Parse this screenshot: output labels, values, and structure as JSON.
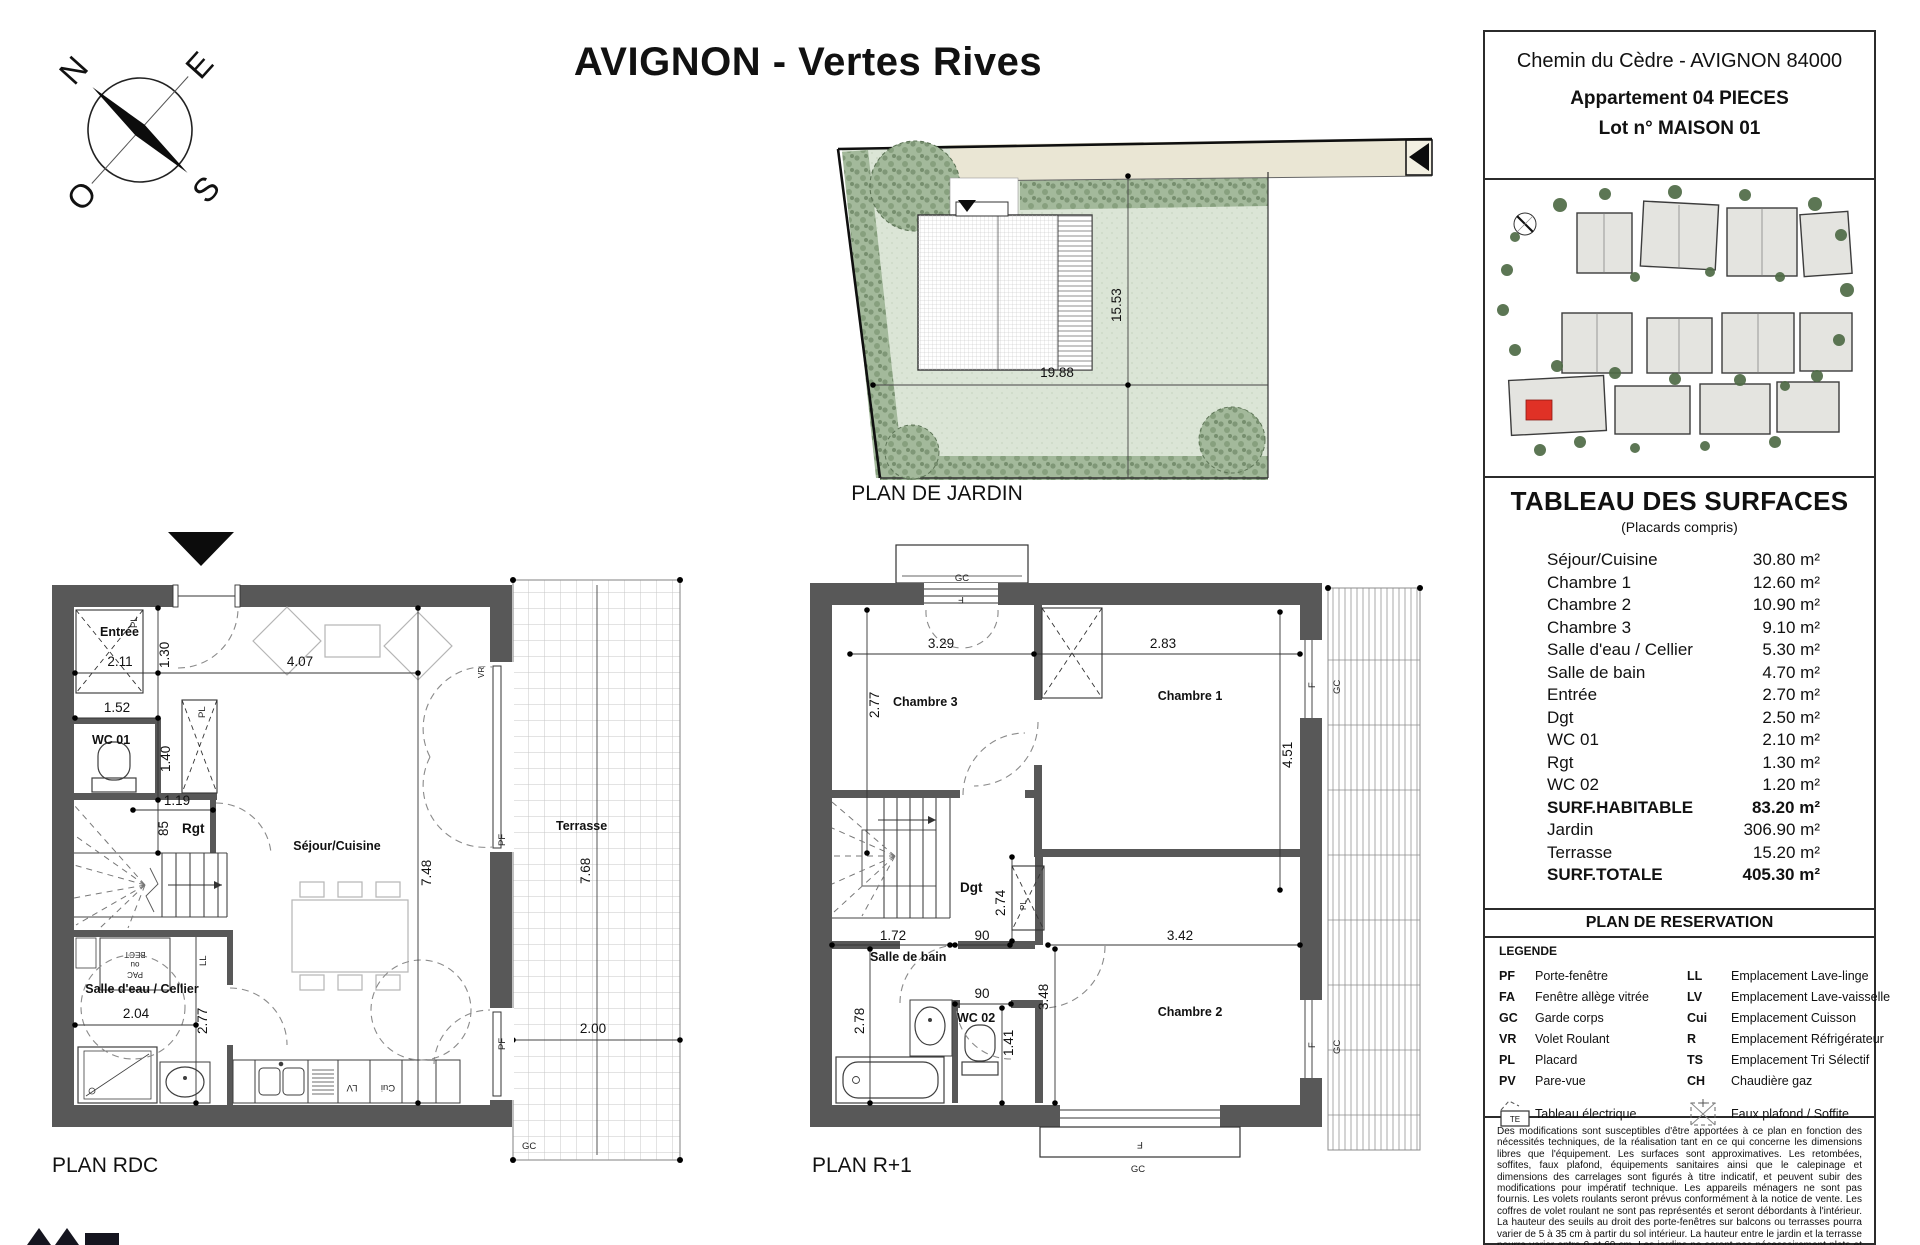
{
  "title": "AVIGNON - Vertes Rives",
  "compass": {
    "n": "N",
    "e": "E",
    "s": "S",
    "o": "O"
  },
  "garden": {
    "label": "PLAN DE JARDIN",
    "d_width": "19.88",
    "d_height": "15.53"
  },
  "rdc": {
    "label": "PLAN RDC",
    "entree": "Entrée",
    "wc01": "WC 01",
    "rgt": "Rgt",
    "sejour": "Séjour/Cuisine",
    "salle_eau": "Salle d'eau / Cellier",
    "terrasse": "Terrasse",
    "d211": "2.11",
    "d130": "1.30",
    "d407": "4.07",
    "d152": "1.52",
    "d140": "1.40",
    "d119": "1.19",
    "d85": "85",
    "d748": "7.48",
    "d204": "2.04",
    "d277": "2.77",
    "d768": "7.68",
    "d200": "2.00",
    "pf": "PF",
    "vr": "VR",
    "gc": "GC",
    "pl": "PL",
    "ll": "LL",
    "lv": "LV",
    "cui": "Cui",
    "pac1": "BECT",
    "pac2": "ou",
    "pac3": "PAC"
  },
  "r1": {
    "label": "PLAN R+1",
    "ch1": "Chambre 1",
    "ch2": "Chambre 2",
    "ch3": "Chambre 3",
    "dgt": "Dgt",
    "sdb": "Salle de bain",
    "wc02": "WC 02",
    "d329": "3.29",
    "d283": "2.83",
    "d277": "2.77",
    "d451": "4.51",
    "d274": "2.74",
    "d172": "1.72",
    "d90a": "90",
    "d90b": "90",
    "d141": "1.41",
    "d342": "3.42",
    "d348": "3.48",
    "d278": "2.78",
    "gc": "GC",
    "f": "F",
    "pl": "PL"
  },
  "sidebar": {
    "address": "Chemin du Cèdre - AVIGNON 84000",
    "apartment": "Appartement 04 PIECES",
    "lot": "Lot n° MAISON 01",
    "surfaces": {
      "title": "TABLEAU DES SURFACES",
      "subtitle": "(Placards compris)",
      "rows": [
        {
          "label": "Séjour/Cuisine",
          "value": "30.80 m²"
        },
        {
          "label": "Chambre 1",
          "value": "12.60 m²"
        },
        {
          "label": "Chambre 2",
          "value": "10.90 m²"
        },
        {
          "label": "Chambre 3",
          "value": "9.10 m²"
        },
        {
          "label": "Salle d'eau / Cellier",
          "value": "5.30 m²"
        },
        {
          "label": "Salle de bain",
          "value": "4.70 m²"
        },
        {
          "label": "Entrée",
          "value": "2.70 m²"
        },
        {
          "label": "Dgt",
          "value": "2.50 m²"
        },
        {
          "label": "WC 01",
          "value": "2.10 m²"
        },
        {
          "label": "Rgt",
          "value": "1.30 m²"
        },
        {
          "label": "WC 02",
          "value": "1.20 m²"
        },
        {
          "label": "SURF.HABITABLE",
          "value": "83.20 m²"
        },
        {
          "label": "Jardin",
          "value": "306.90 m²"
        },
        {
          "label": "Terrasse",
          "value": "15.20 m²"
        },
        {
          "label": "SURF.TOTALE",
          "value": "405.30 m²"
        }
      ]
    },
    "reservation": "PLAN DE RESERVATION",
    "legend": {
      "title": "LEGENDE",
      "left": [
        {
          "abbr": "PF",
          "label": "Porte-fenêtre"
        },
        {
          "abbr": "FA",
          "label": "Fenêtre allège vitrée"
        },
        {
          "abbr": "GC",
          "label": "Garde corps"
        },
        {
          "abbr": "VR",
          "label": "Volet Roulant"
        },
        {
          "abbr": "PL",
          "label": "Placard"
        },
        {
          "abbr": "PV",
          "label": "Pare-vue"
        }
      ],
      "right": [
        {
          "abbr": "LL",
          "label": "Emplacement Lave-linge"
        },
        {
          "abbr": "LV",
          "label": "Emplacement Lave-vaisselle"
        },
        {
          "abbr": "Cui",
          "label": "Emplacement Cuisson"
        },
        {
          "abbr": "R",
          "label": "Emplacement Réfrigérateur"
        },
        {
          "abbr": "TS",
          "label": "Emplacement Tri Sélectif"
        },
        {
          "abbr": "CH",
          "label": "Chaudière gaz"
        }
      ],
      "te_abbr": "TE",
      "te_label": "Tableau électrique",
      "soffite_label": "Faux plafond / Soffite"
    },
    "disclaimer": "Des modifications sont susceptibles d'être apportées à ce plan en fonction des nécessités techniques, de la réalisation tant en ce qui concerne les dimensions libres que l'équipement. Les surfaces sont approximatives. Les retombées, soffites, faux plafond, équipements sanitaires ainsi que le calepinage et dimensions des carrelages sont figurés à titre indicatif, et peuvent subir des modifications pour impératif technique. Les appareils ménagers ne sont pas fournis.  Les volets roulants seront prévus conformément à la notice de vente. Les coffres de volet roulant ne sont pas représentés et seront débordants à l'intérieur. La hauteur des seu­ils au droit des  porte-fenêtres sur balcons ou terrasses pourra varier de 5 à 35 cm à partir du sol intérieur. La hauteur entre le jardin et la terrasse pourra varier entre 0 et 60 cm. Les jardins ne seront pas nécessairement plats et pourront comporter des talus et des pentes."
  }
}
